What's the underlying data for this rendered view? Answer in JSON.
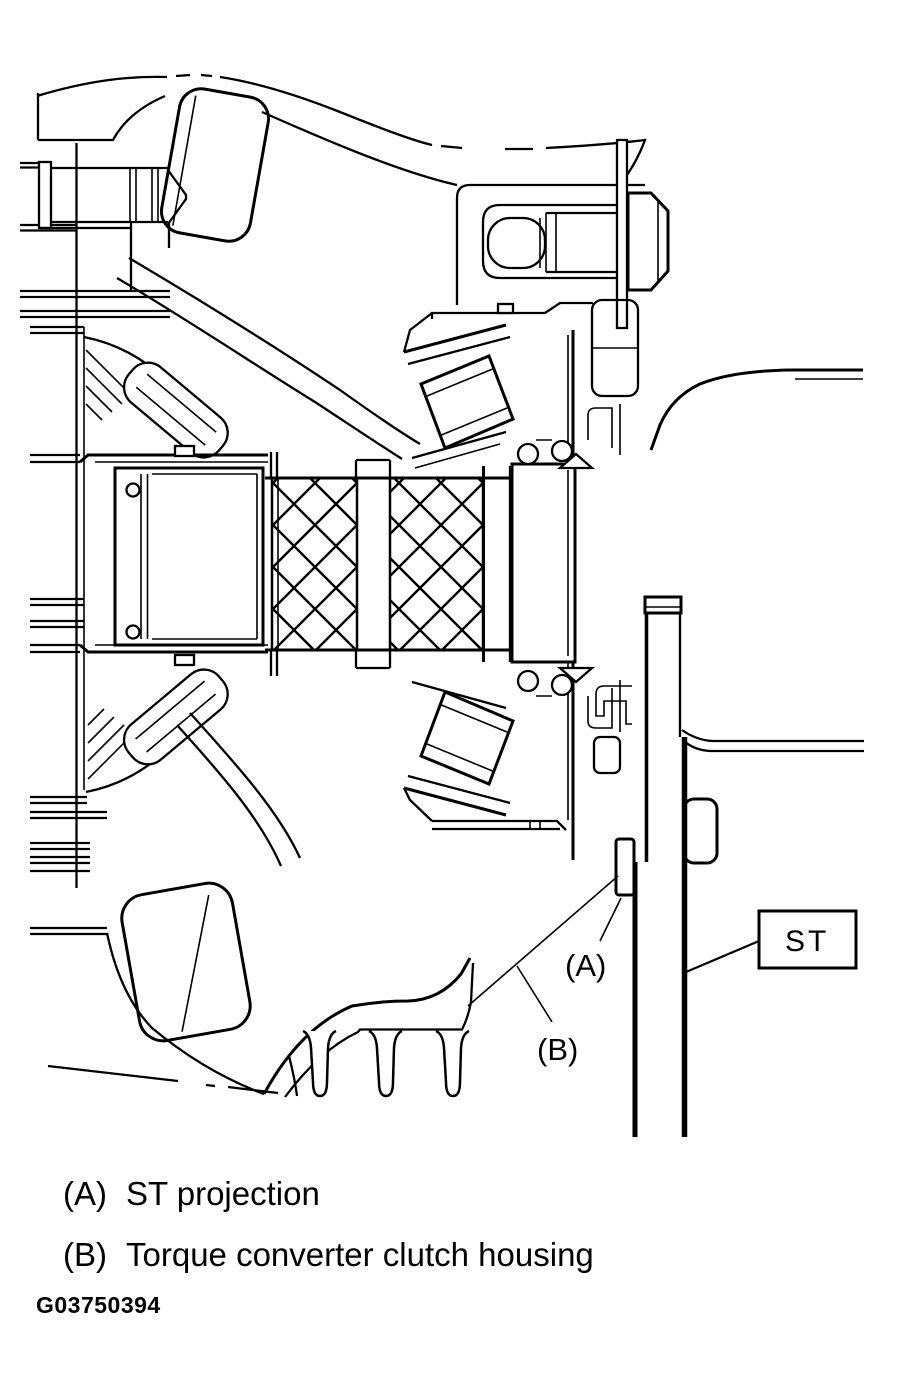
{
  "figure": {
    "description": "Cross-section of transaxle differential and torque converter clutch housing with special tool installed",
    "labels": {
      "a": "(A)",
      "b": "(B)"
    },
    "st_box": "ST",
    "code": "G03750394"
  },
  "legend": {
    "items": [
      {
        "key": "(A)",
        "label": "ST projection"
      },
      {
        "key": "(B)",
        "label": "Torque converter clutch housing"
      }
    ]
  },
  "colors": {
    "line": "#000000",
    "background": "#ffffff"
  }
}
